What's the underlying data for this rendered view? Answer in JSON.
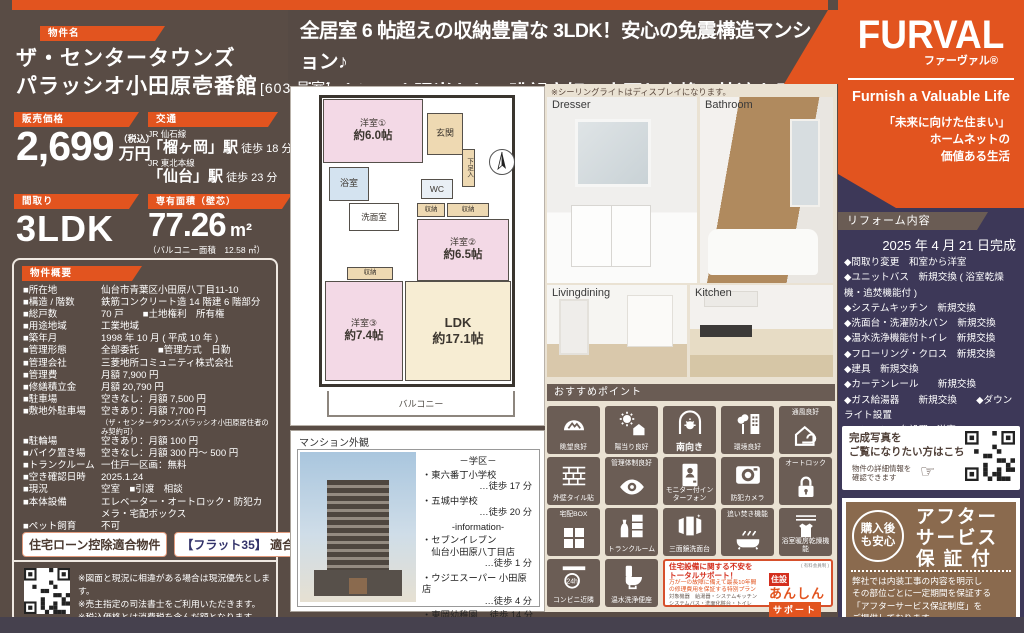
{
  "colors": {
    "accent": "#e2541f",
    "bg_brown": "#594c45",
    "navy": "#3d3858",
    "tile_brown": "#6b5d55",
    "beige": "#eae2d3",
    "after_brown": "#8a6a4e"
  },
  "headline": {
    "line1": "全居室 6 帖超えの収納豊富な 3LDK！安心の免震構造マンション♪",
    "line2": "南向きにつき陽当たり・眺望良好！水回り交換で快適な居住空間の実現♪"
  },
  "property": {
    "label": "物件名",
    "name_line1": "ザ・センタータウンズ",
    "name_line2": "パラッシオ小田原壱番館",
    "room_no": "[603 号室]",
    "price": {
      "label": "販売価格",
      "value": "2,699",
      "tax": "（税込）",
      "unit": "万円"
    },
    "access": {
      "label": "交通",
      "lines": [
        {
          "rail": "JR 仙石線",
          "station": "「榴ヶ岡」駅",
          "walk": "徒歩 18 分"
        },
        {
          "rail": "JR 東北本線",
          "station": "「仙台」駅",
          "walk": "徒歩 23 分"
        }
      ]
    },
    "layout": {
      "label": "間取り",
      "value": "3LDK"
    },
    "area": {
      "label": "専有面積（壁芯）",
      "value": "77.26",
      "unit": "m²",
      "note": "（バルコニー面積　12.58 ㎡）"
    }
  },
  "overview": {
    "label": "物件概要",
    "rows": [
      {
        "term": "■所在地",
        "value": "仙台市青葉区小田原八丁目11-10"
      },
      {
        "term": "■構造 / 階数",
        "value": "鉄筋コンクリート造 14 階建 6 階部分"
      },
      {
        "term": "■総戸数",
        "value": "70 戸　　■土地権利　所有権"
      },
      {
        "term": "■用途地域",
        "value": "工業地域"
      },
      {
        "term": "■築年月",
        "value": "1998 年 10 月 ( 平成 10 年 )"
      },
      {
        "term": "■管理形態",
        "value": "全部委託　　■管理方式　日勤"
      },
      {
        "term": "■管理会社",
        "value": "三菱地所コミュニティ株式会社"
      },
      {
        "term": "■管理費",
        "value": "月額 7,900 円"
      },
      {
        "term": "■修繕積立金",
        "value": "月額 20,790 円"
      },
      {
        "term": "■駐車場",
        "value": "空きなし：月額 7,500 円"
      },
      {
        "term": "■敷地外駐車場",
        "value": "空きあり：月額 7,700 円",
        "note": "（ザ・センタータウンズパラッシオ小田原居住者のみ契約可）"
      },
      {
        "term": "■駐輪場",
        "value": "空きあり：月額 100 円"
      },
      {
        "term": "■バイク置き場",
        "value": "空きなし：月額 300 円～ 500 円"
      },
      {
        "term": "■トランクルーム",
        "value": "一住戸一区画：無料"
      },
      {
        "term": "■空き確認日時",
        "value": "2025.1.24"
      },
      {
        "term": "■現況",
        "value": "空室　■引渡　相談"
      },
      {
        "term": "■本体設備",
        "value": "エレベーター・オートロック・防犯カメラ・宅配ボックス"
      },
      {
        "term": "■ペット飼育",
        "value": "不可"
      }
    ]
  },
  "badges": {
    "loan": "住宅ローン控除適合物件",
    "flat_prefix": "【フラット35】",
    "flat_suffix": " 適合物件"
  },
  "map": {
    "caption": "Google Map",
    "notes": [
      "※図面と現況に相違がある場合は現況優先とします。",
      "※売主指定の司法書士をご利用いただきます。",
      "※税込価格とは消費税を含んだ額となります。"
    ]
  },
  "floorplan": {
    "rooms": {
      "y1_name": "洋室①",
      "y1_size": "約6.0帖",
      "genkan": "玄関",
      "geta": "下足入",
      "bath": "浴室",
      "senmen": "洗面室",
      "wc": "WC",
      "closet": "収納",
      "y2_name": "洋室②",
      "y2_size": "約6.5帖",
      "y3_name": "洋室③",
      "y3_size": "約7.4帖",
      "ldk_name": "LDK",
      "ldk_size": "約17.1帖",
      "balcony": "バルコニー"
    }
  },
  "exterior": {
    "label": "マンション外観",
    "school_header": "－学区－",
    "schools": [
      {
        "name": "・東六番丁小学校",
        "walk": "…徒歩 17 分"
      },
      {
        "name": "・五城中学校",
        "walk": "…徒歩 20 分"
      }
    ],
    "info_header": "-information-",
    "infos": [
      {
        "name": "・セブンイレブン",
        "name2": "　仙台小田原八丁目店",
        "walk": "…徒歩 1 分"
      },
      {
        "name": "・ウジエスーパー 小田原店",
        "walk": "…徒歩 4 分"
      },
      {
        "name": "・東岡幼稚園 …徒歩 14 分",
        "walk": ""
      }
    ]
  },
  "photos": {
    "note": "※シーリングライトはディスプレイになります。",
    "labels": {
      "dresser": "Dresser",
      "bathroom": "Bathroom",
      "living": "Livingdining",
      "kitchen": "Kitchen"
    }
  },
  "points": {
    "label": "おすすめポイント",
    "icons": [
      {
        "label": "眺望良好",
        "glyph": "view",
        "pos": "lb"
      },
      {
        "label": "陽当り良好",
        "glyph": "sun",
        "pos": "lb"
      },
      {
        "label": "南向き",
        "glyph": "south",
        "pos": "lb",
        "big": true
      },
      {
        "label": "環境良好",
        "glyph": "env",
        "pos": "lb"
      },
      {
        "label": "通風良好",
        "glyph": "wind",
        "pos": "lt"
      },
      {
        "label": "外壁タイル貼",
        "glyph": "brick",
        "pos": "lb"
      },
      {
        "label": "管理体制良好",
        "glyph": "eye",
        "pos": "lt"
      },
      {
        "label": "モニター付インターフォン",
        "glyph": "monitor",
        "pos": "lb"
      },
      {
        "label": "防犯カメラ",
        "glyph": "camera",
        "pos": "lb"
      },
      {
        "label": "オートロック",
        "glyph": "lock",
        "pos": "lt"
      },
      {
        "label": "宅配BOX",
        "glyph": "box",
        "pos": "lt"
      },
      {
        "label": "トランクルーム",
        "glyph": "trunk",
        "pos": "lb"
      },
      {
        "label": "三面鏡洗面台",
        "glyph": "mirror",
        "pos": "lb"
      },
      {
        "label": "追い焚き機能",
        "glyph": "tub",
        "pos": "lt"
      },
      {
        "label": "浴室暖房乾燥機能",
        "glyph": "dryer",
        "pos": "lb"
      },
      {
        "label": "コンビニ近隣",
        "glyph": "c24",
        "pos": "lb"
      },
      {
        "label": "温水洗浄便座",
        "glyph": "toilet",
        "pos": "lb"
      }
    ]
  },
  "support": {
    "h1": "住宅設備に関する不安を",
    "h2": "トータルサポート！",
    "s1": "万が一の故障に備えて最長10年間",
    "s2": "の修理費用を保証する特別プラン",
    "t1": "対象機器　給湯器・システムキッチン",
    "t2": "システムバス・洗面化粧台・トイレ",
    "member": "( 有料会員制 )",
    "b1": "住設",
    "b2": "あんしん",
    "b3": "サポート"
  },
  "brand": {
    "logo": "FURVAL",
    "kana": "ファーヴァル®",
    "slogan": "Furnish a Valuable Life",
    "tagline": [
      "「未来に向けた住まい」",
      "ホームネットの",
      "価値ある生活"
    ]
  },
  "reform": {
    "label": "リフォーム内容",
    "date": "2025 年 4 月 21 日完成",
    "items": [
      "◆間取り変更　和室から洋室",
      "◆ユニットバス　新規交換 ( 浴室乾燥機・追焚機能付 )",
      "◆システムキッチン　新規交換",
      "◆洗面台・洗濯防水パン　新規交換",
      "◆温水洗浄機能付トイレ　新規交換",
      "◆フローリング・クロス　新規交換",
      "◆建具　新規交換",
      "◆カーテンレール　　新規交換",
      "◆ガス給湯器　　新規交換　　◆ダウンライト設置",
      "◆エアコン一台設置 ( 洋室③ )",
      "◆ハウスクリーニング　他"
    ]
  },
  "photo_qr": {
    "line1": "完成写真を",
    "line2": "ご覧になりたい方はこちら",
    "sub1": "物件の詳細情報を",
    "sub2": "確認できます",
    "hand": "☞"
  },
  "after": {
    "badge_line1": "購入後",
    "badge_line2": "も安心",
    "title": [
      "アフター",
      "サービス",
      "保 証 付"
    ],
    "body": [
      "弊社では内装工事の内容を明示し",
      "その部位ごとに一定期間を保証する",
      "「アフターサービス保証制度」を",
      "ご提供しております。"
    ]
  }
}
